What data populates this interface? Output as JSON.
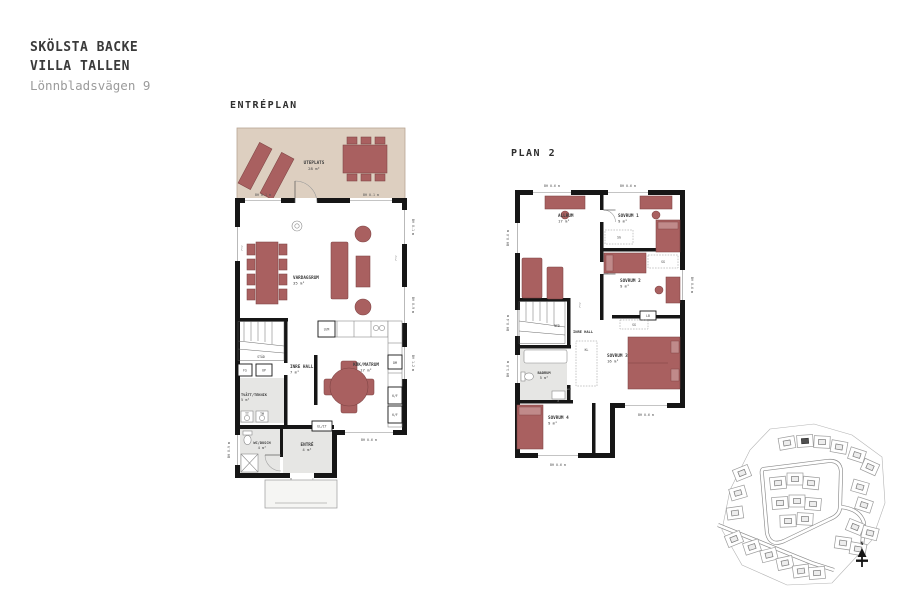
{
  "header": {
    "line1": "SKÖLSTA BACKE",
    "line2": "VILLA TALLEN",
    "line3": "Lönnbladsvägen 9"
  },
  "floor1": {
    "title": "ENTRÉPLAN",
    "rooms": {
      "uteplats": {
        "name": "UTEPLATS",
        "area": "28 m²"
      },
      "vardagsrum": {
        "name": "VARDAGSRUM",
        "area": "35 m²"
      },
      "kok": {
        "name": "KÖK/MATRUM",
        "area": "17 m²"
      },
      "hall": {
        "name": "INRE HALL",
        "area": "7 m²"
      },
      "tvatt": {
        "name": "TVÄTT/TEKNIK",
        "area": "5 m²"
      },
      "wc": {
        "name": "WC/DUSCH",
        "area": "4 m²"
      },
      "entre": {
        "name": "ENTRÉ",
        "area": "4 m²"
      }
    },
    "labels": {
      "stad": "STÄD",
      "fs": "FS",
      "up": "UP",
      "um": "U/M",
      "dm": "DM",
      "kf1": "K/F",
      "kf2": "K/F",
      "tt": "TT",
      "tm": "TM",
      "elit": "EL/IT",
      "ftv1": "FTV",
      "ftv2": "FTV"
    },
    "dims": {
      "top_left": "BH 0.1 m",
      "top_right": "BH 0.1 m",
      "right_top": "BH 0.1 m",
      "right_mid": "BH 0.9 m",
      "right_low": "BH 1.2 m",
      "bottom": "BH 0.6 m",
      "left": "BH 0.9 m"
    }
  },
  "floor2": {
    "title": "PLAN 2",
    "rooms": {
      "allrum": {
        "name": "ALLRUM",
        "area": "17 m²"
      },
      "sovrum1": {
        "name": "SOVRUM 1",
        "area": "9 m²"
      },
      "sovrum2": {
        "name": "SOVRUM 2",
        "area": "9 m²"
      },
      "sovrum3": {
        "name": "SOVRUM 3",
        "area": "16 m²"
      },
      "sovrum4": {
        "name": "SOVRUM 4",
        "area": "9 m²"
      },
      "badrum": {
        "name": "BADRUM",
        "area": "5 m²"
      },
      "hall": {
        "name": "INRE HALL"
      }
    },
    "labels": {
      "ned": "NED",
      "sg1": "SG",
      "sg2": "SG",
      "sg3": "SG",
      "lb": "LB",
      "kl": "KL",
      "ftv": "FTV"
    },
    "dims": {
      "top_left": "BH 0.6 m",
      "top_right": "BH 0.6 m",
      "left_top": "BH 0.6 m",
      "left_mid": "BH 0.4 m",
      "left_low": "BH 1.0 m",
      "right": "BH 0.6 m",
      "bottom_right": "BH 0.6 m",
      "bottom_left": "BH 0.6 m"
    }
  },
  "siteplan": {
    "north_label": "N",
    "lots": [
      {
        "x": 75,
        "y": 28,
        "r": -10
      },
      {
        "x": 93,
        "y": 26,
        "r": -4,
        "hl": true
      },
      {
        "x": 110,
        "y": 27,
        "r": 3
      },
      {
        "x": 127,
        "y": 32,
        "r": 10
      },
      {
        "x": 145,
        "y": 40,
        "r": 18
      },
      {
        "x": 158,
        "y": 52,
        "r": 24
      },
      {
        "x": 30,
        "y": 58,
        "r": -22
      },
      {
        "x": 26,
        "y": 78,
        "r": -16
      },
      {
        "x": 23,
        "y": 98,
        "r": -8
      },
      {
        "x": 66,
        "y": 68,
        "r": -6
      },
      {
        "x": 83,
        "y": 64,
        "r": 0
      },
      {
        "x": 99,
        "y": 68,
        "r": 6
      },
      {
        "x": 68,
        "y": 88,
        "r": -4
      },
      {
        "x": 85,
        "y": 86,
        "r": 0
      },
      {
        "x": 101,
        "y": 89,
        "r": 5
      },
      {
        "x": 76,
        "y": 106,
        "r": -2
      },
      {
        "x": 93,
        "y": 104,
        "r": 3
      },
      {
        "x": 148,
        "y": 72,
        "r": 16
      },
      {
        "x": 152,
        "y": 90,
        "r": 18
      },
      {
        "x": 143,
        "y": 112,
        "r": 22
      },
      {
        "x": 158,
        "y": 118,
        "r": 14
      },
      {
        "x": 131,
        "y": 128,
        "r": 8
      },
      {
        "x": 146,
        "y": 134,
        "r": 10
      },
      {
        "x": 22,
        "y": 124,
        "r": -22
      },
      {
        "x": 40,
        "y": 132,
        "r": -18
      },
      {
        "x": 57,
        "y": 140,
        "r": -14
      },
      {
        "x": 73,
        "y": 148,
        "r": -12
      },
      {
        "x": 89,
        "y": 156,
        "r": -8
      },
      {
        "x": 105,
        "y": 158,
        "r": -5
      }
    ]
  },
  "colors": {
    "furniture": "#a96060",
    "terrace": "#ddcfc0",
    "wall": "#161616",
    "wet_room": "#e6e6e4"
  }
}
